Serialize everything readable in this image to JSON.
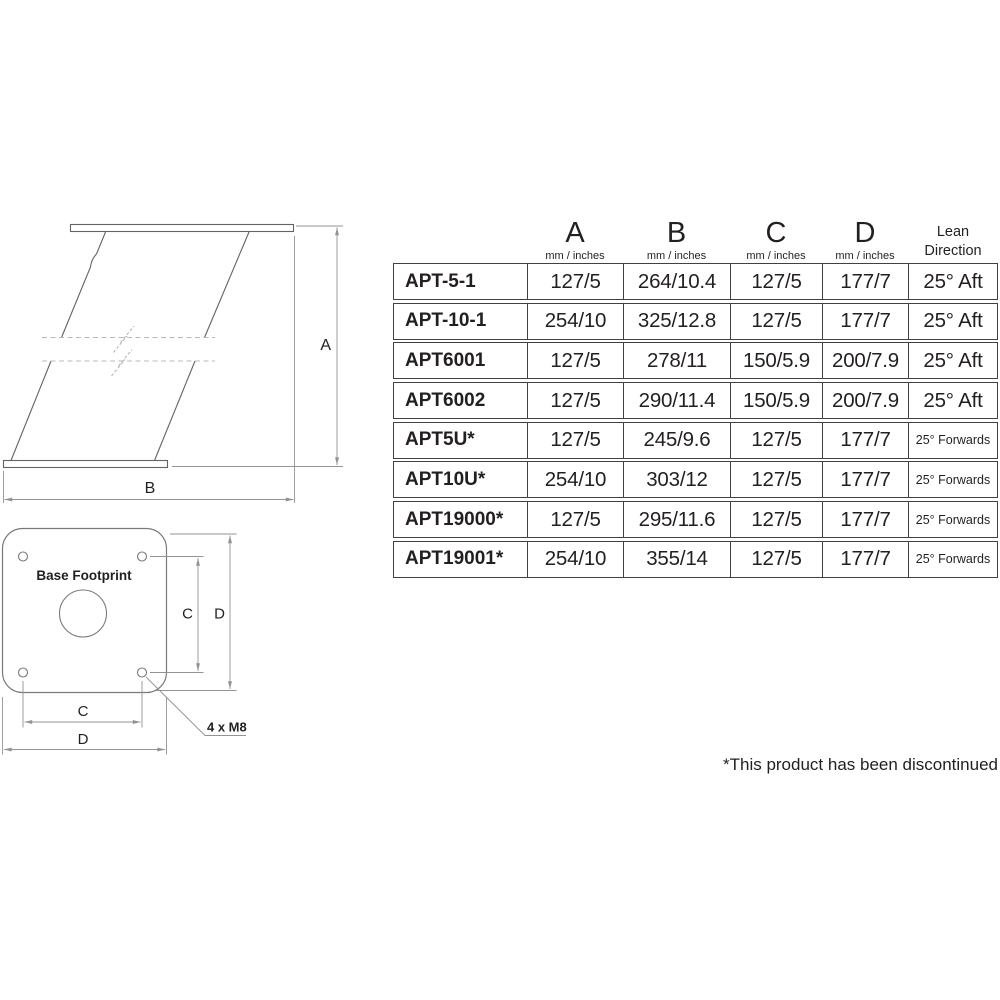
{
  "colors": {
    "ink": "#231f20",
    "drawing_line": "#636363",
    "dim_line": "#919396",
    "table_border": "#414042"
  },
  "diagram": {
    "side_view": {
      "dim_a_label": "A",
      "dim_b_label": "B"
    },
    "base_footprint": {
      "title": "Base Footprint",
      "dim_c_right_label": "C",
      "dim_d_right_label": "D",
      "dim_c_bottom_label": "C",
      "dim_d_bottom_label": "D",
      "bolt_note": "4 x M8"
    }
  },
  "table": {
    "headers": [
      {
        "label": "A",
        "sub": "mm / inches"
      },
      {
        "label": "B",
        "sub": "mm / inches"
      },
      {
        "label": "C",
        "sub": "mm / inches"
      },
      {
        "label": "D",
        "sub": "mm / inches"
      }
    ],
    "lean_header": {
      "line1": "Lean",
      "line2": "Direction"
    },
    "rows": [
      {
        "model": "APT-5-1",
        "a": "127/5",
        "b": "264/10.4",
        "c": "127/5",
        "d": "177/7",
        "lean": "25° Aft"
      },
      {
        "model": "APT-10-1",
        "a": "254/10",
        "b": "325/12.8",
        "c": "127/5",
        "d": "177/7",
        "lean": "25° Aft"
      },
      {
        "model": "APT6001",
        "a": "127/5",
        "b": "278/11",
        "c": "150/5.9",
        "d": "200/7.9",
        "lean": "25° Aft"
      },
      {
        "model": "APT6002",
        "a": "127/5",
        "b": "290/11.4",
        "c": "150/5.9",
        "d": "200/7.9",
        "lean": "25° Aft"
      },
      {
        "model": "APT5U*",
        "a": "127/5",
        "b": "245/9.6",
        "c": "127/5",
        "d": "177/7",
        "lean": "25° Forwards"
      },
      {
        "model": "APT10U*",
        "a": "254/10",
        "b": "303/12",
        "c": "127/5",
        "d": "177/7",
        "lean": "25° Forwards"
      },
      {
        "model": "APT19000*",
        "a": "127/5",
        "b": "295/11.6",
        "c": "127/5",
        "d": "177/7",
        "lean": "25° Forwards"
      },
      {
        "model": "APT19001*",
        "a": "254/10",
        "b": "355/14",
        "c": "127/5",
        "d": "177/7",
        "lean": "25° Forwards"
      }
    ]
  },
  "footnote": "*This product has been discontinued"
}
